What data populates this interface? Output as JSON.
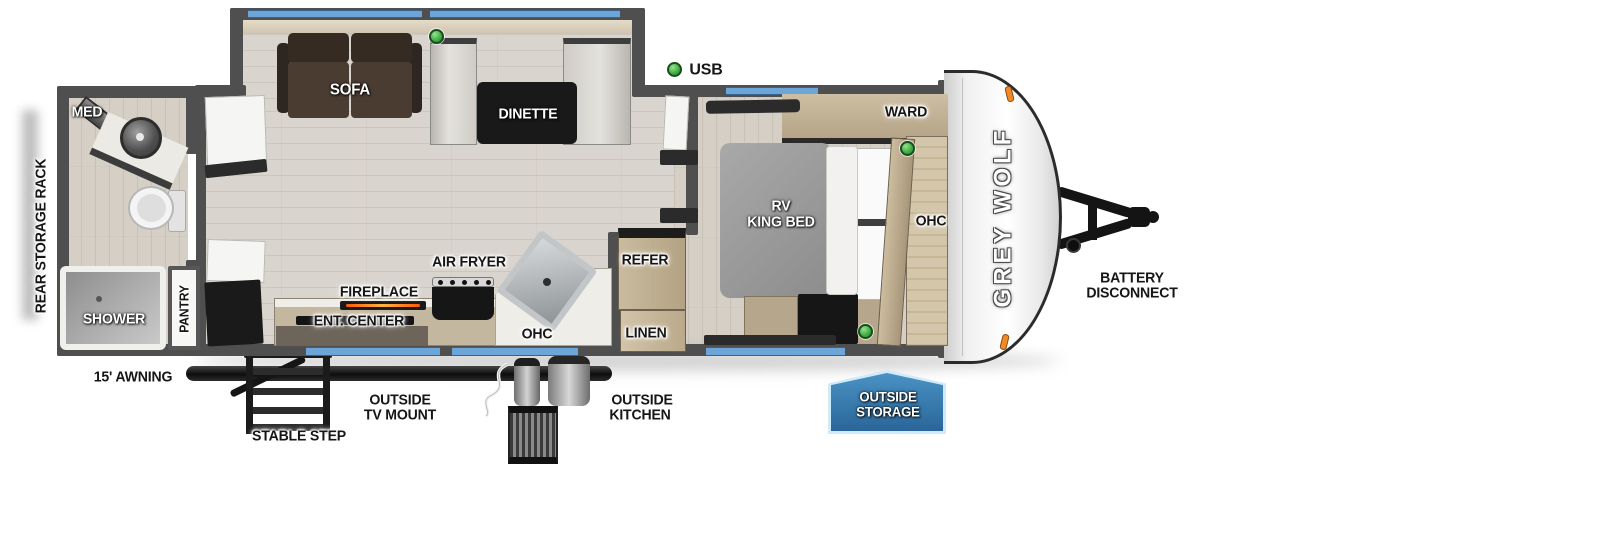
{
  "brand": "GREY WOLF",
  "legend": {
    "usb_label": "USB"
  },
  "bathroom": {
    "med": "MED",
    "shower": "SHOWER",
    "pantry": "PANTRY"
  },
  "living": {
    "sofa": "SOFA",
    "dinette": "DINETTE"
  },
  "kitchen": {
    "air_fryer": "AIR FRYER",
    "fireplace": "FIREPLACE",
    "ent_center": "ENT. CENTER",
    "ohc": "OHC",
    "refer": "REFER",
    "linen": "LINEN"
  },
  "bedroom": {
    "bed_line1": "RV",
    "bed_line2": "KING BED",
    "ward": "WARD",
    "ohc": "OHC"
  },
  "exterior": {
    "rear_storage_rack": "REAR STORAGE RACK",
    "awning": "15' AWNING",
    "stable_step": "STABLE STEP",
    "outside_tv_mount": [
      "OUTSIDE",
      "TV MOUNT"
    ],
    "outside_kitchen": [
      "OUTSIDE",
      "KITCHEN"
    ],
    "outside_storage": [
      "OUTSIDE",
      "STORAGE"
    ],
    "battery_disconnect": [
      "BATTERY",
      "DISCONNECT"
    ]
  },
  "colors": {
    "window_blue": "#6ca6d9",
    "wall_gray": "#4f4f4f",
    "usb_green": "#3aa93f",
    "storage_badge_blue": "#2e6da3",
    "marker_orange": "#f08a28"
  }
}
